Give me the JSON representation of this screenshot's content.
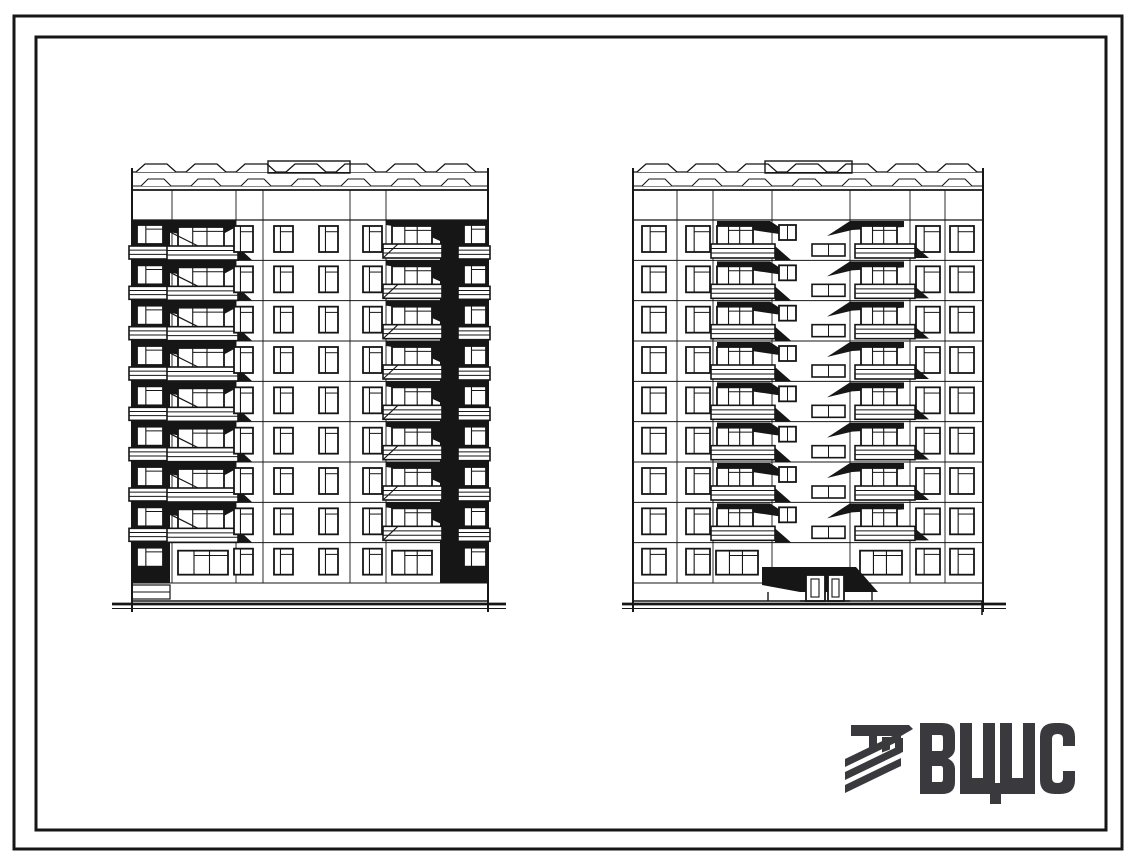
{
  "logo": {
    "text": "ВЦИС",
    "icon": "hatched-monogram-icon",
    "color": "#3a3a3e"
  },
  "drawing": {
    "ink_color": "#161616",
    "background": "#ffffff",
    "sheet_frame": "double rectangular border",
    "elevations": [
      {
        "name": "left-facade",
        "floors": 9,
        "balcony_rows": 8,
        "features": "end elevation: dark corner bays with recessed balconies, two balcony stacks, four window bays, black vertical accent stripe, scalloped parapet vents, rooftop machine room"
      },
      {
        "name": "right-facade",
        "floors": 9,
        "balcony_rows": 8,
        "features": "entrance elevation: central staircase bay with small landing windows, two cascading balcony stacks, ground-floor entrance with dark canopy and double glazed door, scalloped parapet vents, rooftop machine room"
      }
    ]
  }
}
